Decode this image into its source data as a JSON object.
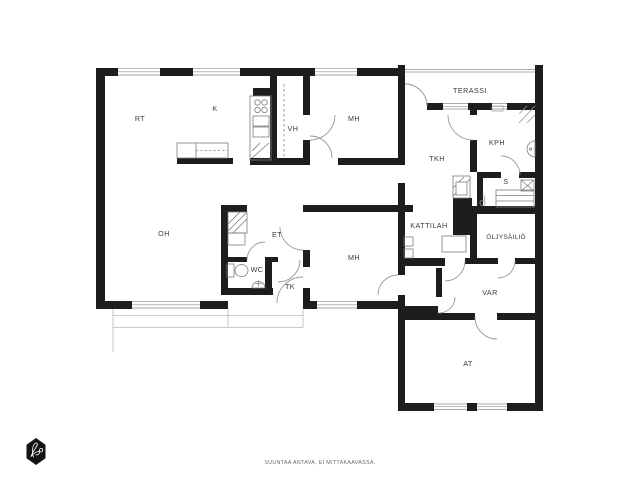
{
  "meta": {
    "type": "floor-plan",
    "disclaimer": "SUUNTAA ANTAVA, EI MITTAKAAVASSA."
  },
  "colors": {
    "wall": "#1d1d1d",
    "door_arc": "#9a9a9a",
    "fixture_line": "#7d7d7d",
    "window_line": "#8f8f8f",
    "patio_line": "#b9b9b9",
    "label_text": "#3a3a3a",
    "footer_text": "#6a6a6a",
    "logo_bg": "#141414"
  },
  "rooms": {
    "rt": {
      "label": "RT"
    },
    "k": {
      "label": "K"
    },
    "vh": {
      "label": "VH"
    },
    "mh_top": {
      "label": "MH"
    },
    "terassi": {
      "label": "TERASSI"
    },
    "tkh": {
      "label": "TKH"
    },
    "kph": {
      "label": "KPH"
    },
    "s": {
      "label": "S"
    },
    "oh": {
      "label": "OH"
    },
    "et": {
      "label": "ET"
    },
    "wc": {
      "label": "WC"
    },
    "tk": {
      "label": "TK"
    },
    "mh_bottom": {
      "label": "MH"
    },
    "kattilah": {
      "label": "KATTILAH"
    },
    "oljysailio": {
      "label": "ÖLJYSÄILIÖ"
    },
    "var": {
      "label": "VAR"
    },
    "at": {
      "label": "AT"
    }
  },
  "logo": {
    "monogram": "Bo"
  }
}
